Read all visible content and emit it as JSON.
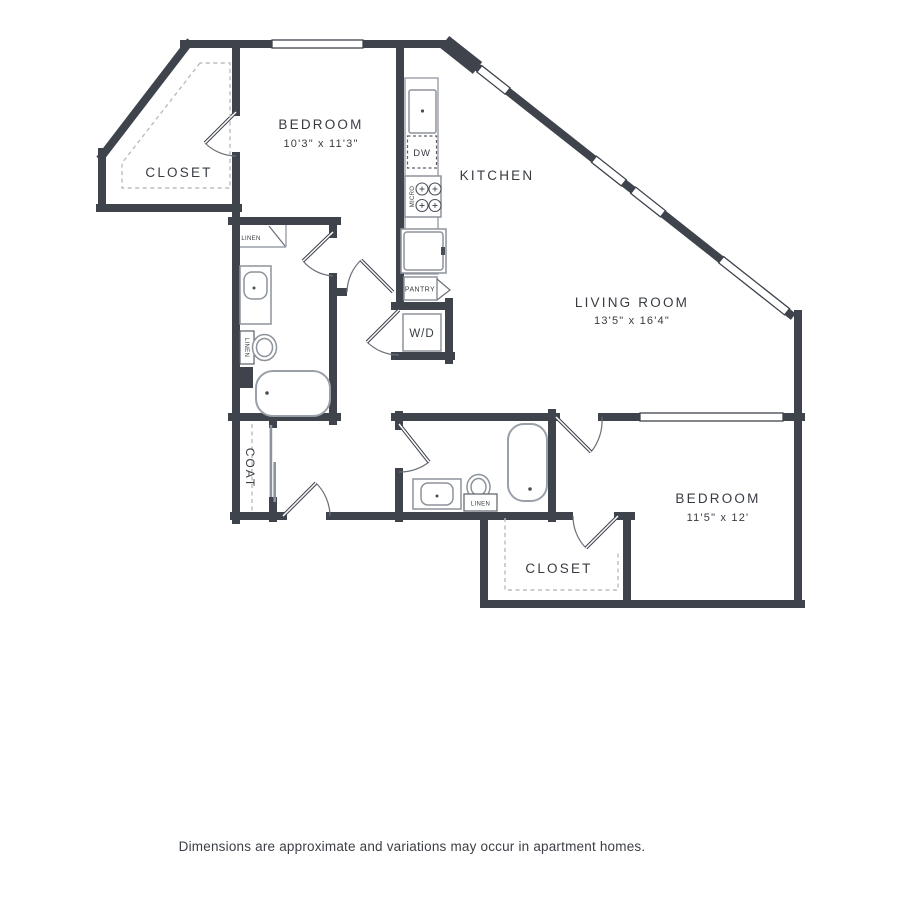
{
  "floor_plan": {
    "rooms": {
      "bedroom_1": {
        "label": "BEDROOM",
        "dims": "10'3\" x 11'3\""
      },
      "closet_1": {
        "label": "CLOSET"
      },
      "kitchen": {
        "label": "KITCHEN"
      },
      "living_room": {
        "label": "LIVING ROOM",
        "dims": "13'5\" x 16'4\""
      },
      "bedroom_2": {
        "label": "BEDROOM",
        "dims": "11'5\" x 12'"
      },
      "closet_2": {
        "label": "CLOSET"
      },
      "coat_closet": {
        "label": "COAT"
      }
    },
    "fixtures": {
      "washer_dryer": "W/D",
      "pantry": "PANTRY",
      "dishwasher": "DW",
      "microwave": "MICRO",
      "linen_bath1_top": "LINEN",
      "linen_bath1_cabinet": "LINEN",
      "linen_bath2": "LINEN"
    },
    "colors": {
      "wall": "#3e434c",
      "fixture_line": "#9aa0a8",
      "dash_line": "#b9bdc3",
      "text": "#383c42"
    },
    "footer": {
      "disclaimer": "Dimensions are approximate and variations may occur in apartment homes."
    }
  }
}
